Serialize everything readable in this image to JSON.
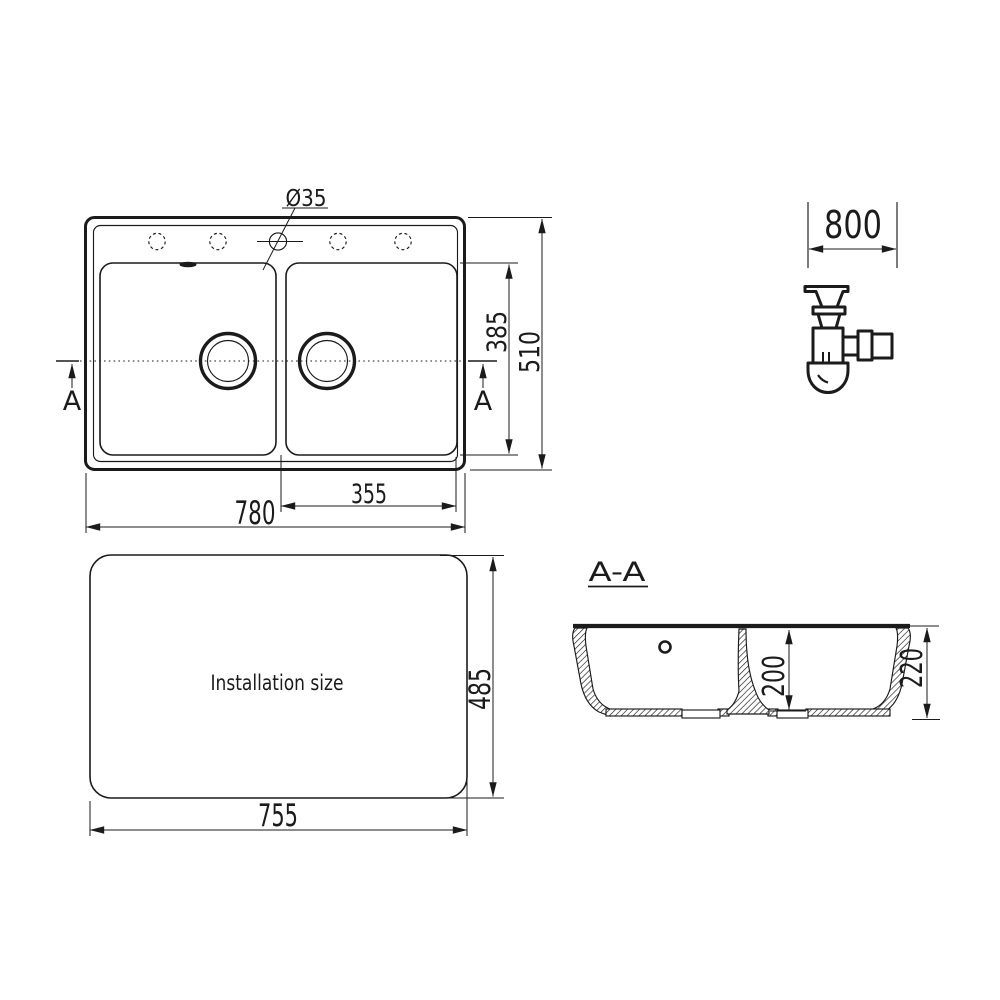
{
  "top_view": {
    "hole_diameter_label": "Ø35",
    "dim_width": "780",
    "dim_height": "510",
    "dim_bowl_width": "355",
    "dim_bowl_height": "385",
    "section_marker_left": "A",
    "section_marker_right": "A"
  },
  "cabinet": {
    "dim_width": "800"
  },
  "installation_view": {
    "label": "Installation size",
    "dim_width": "755",
    "dim_height": "485"
  },
  "section_view": {
    "title": "A-A",
    "dim_inner_depth": "200",
    "dim_total_depth": "220"
  },
  "colors": {
    "line": "#1b1b1b",
    "background": "#ffffff"
  }
}
